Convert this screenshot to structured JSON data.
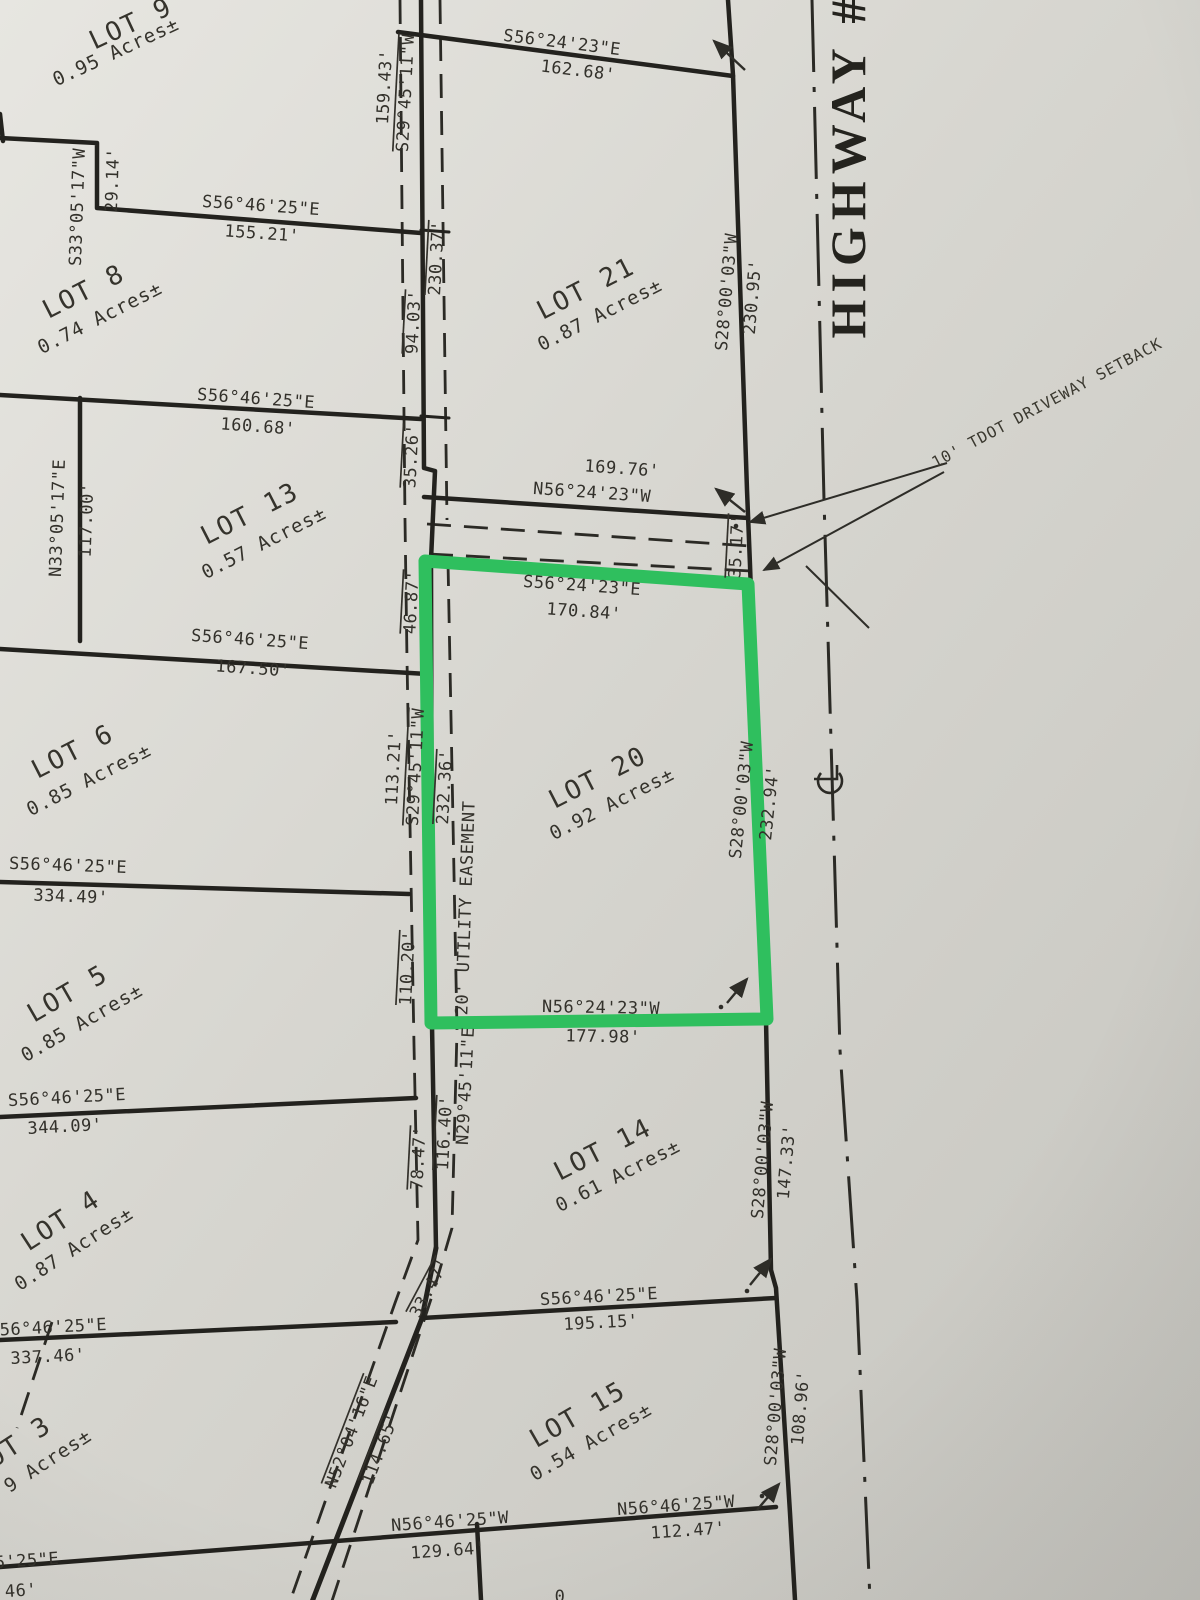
{
  "document": {
    "type": "subdivision-plat-scan",
    "highlighted_lot": "LOT 20"
  },
  "colors": {
    "highlight": "#2fbf5e",
    "ink": "#23221e",
    "paper_light": "#e6e5e0",
    "paper_mid": "#d7d6d0",
    "paper_dark": "#c7c6c0"
  },
  "labels": [
    {
      "n": "lot-9-name",
      "t": "LOT 9",
      "x": 131,
      "y": 24,
      "r": -25,
      "c": "lot-name"
    },
    {
      "n": "lot-9-area",
      "t": "0.95 Acres±",
      "x": 116,
      "y": 52,
      "r": -25,
      "c": "lot-area"
    },
    {
      "n": "lot-8-name",
      "t": "LOT 8",
      "x": 84,
      "y": 292,
      "r": -27,
      "c": "lot-name"
    },
    {
      "n": "lot-8-area",
      "t": "0.74 Acres±",
      "x": 100,
      "y": 318,
      "r": -27,
      "c": "lot-area"
    },
    {
      "n": "lot-13-name",
      "t": "LOT 13",
      "x": 250,
      "y": 514,
      "r": -27,
      "c": "lot-name"
    },
    {
      "n": "lot-13-area",
      "t": "0.57 Acres±",
      "x": 264,
      "y": 543,
      "r": -27,
      "c": "lot-area"
    },
    {
      "n": "lot-6-name",
      "t": "LOT 6",
      "x": 73,
      "y": 752,
      "r": -27,
      "c": "lot-name"
    },
    {
      "n": "lot-6-area",
      "t": "0.85 Acres±",
      "x": 89,
      "y": 780,
      "r": -27,
      "c": "lot-area"
    },
    {
      "n": "lot-5-name",
      "t": "LOT 5",
      "x": 68,
      "y": 994,
      "r": -30,
      "c": "lot-name"
    },
    {
      "n": "lot-5-area",
      "t": "0.85 Acres±",
      "x": 82,
      "y": 1023,
      "r": -30,
      "c": "lot-area"
    },
    {
      "n": "lot-4-name",
      "t": "LOT 4",
      "x": 61,
      "y": 1221,
      "r": -33,
      "c": "lot-name"
    },
    {
      "n": "lot-4-area",
      "t": "0.87 Acres±",
      "x": 74,
      "y": 1249,
      "r": -33,
      "c": "lot-area"
    },
    {
      "n": "lot-3-name",
      "t": "LOT 3",
      "x": 12,
      "y": 1447,
      "r": -33,
      "c": "lot-name"
    },
    {
      "n": "lot-3-area",
      "t": "9 Acres±",
      "x": 48,
      "y": 1461,
      "r": -33,
      "c": "lot-area"
    },
    {
      "n": "lot-21-name",
      "t": "LOT 21",
      "x": 586,
      "y": 289,
      "r": -27,
      "c": "lot-name"
    },
    {
      "n": "lot-21-area",
      "t": "0.87 Acres±",
      "x": 600,
      "y": 315,
      "r": -27,
      "c": "lot-area"
    },
    {
      "n": "lot-20-name",
      "t": "LOT 20",
      "x": 598,
      "y": 778,
      "r": -27,
      "c": "lot-name"
    },
    {
      "n": "lot-20-area",
      "t": "0.92 Acres±",
      "x": 612,
      "y": 804,
      "r": -27,
      "c": "lot-area"
    },
    {
      "n": "lot-14-name",
      "t": "LOT 14",
      "x": 603,
      "y": 1150,
      "r": -27,
      "c": "lot-name"
    },
    {
      "n": "lot-14-area",
      "t": "0.61 Acres±",
      "x": 618,
      "y": 1176,
      "r": -27,
      "c": "lot-area"
    },
    {
      "n": "lot-15-name",
      "t": "LOT 15",
      "x": 578,
      "y": 1415,
      "r": -30,
      "c": "lot-name"
    },
    {
      "n": "lot-15-area",
      "t": "0.54 Acres±",
      "x": 591,
      "y": 1442,
      "r": -30,
      "c": "lot-area"
    },
    {
      "n": "dim-bearing-155",
      "t": "S56°46'25\"E",
      "x": 261,
      "y": 206,
      "r": 4,
      "c": "dim"
    },
    {
      "n": "dim-155-21",
      "t": "155.21'",
      "x": 262,
      "y": 234,
      "r": 4,
      "c": "dim"
    },
    {
      "n": "dim-bearing-s330517w",
      "t": "S33°05'17\"W",
      "x": 78,
      "y": 207,
      "r": -88,
      "c": "dim"
    },
    {
      "n": "dim-29-14",
      "t": "29.14'",
      "x": 113,
      "y": 180,
      "r": -88,
      "c": "dim"
    },
    {
      "n": "dim-bearing-160",
      "t": "S56°46'25\"E",
      "x": 256,
      "y": 399,
      "r": 4,
      "c": "dim"
    },
    {
      "n": "dim-160-68",
      "t": "160.68'",
      "x": 258,
      "y": 427,
      "r": 4,
      "c": "dim"
    },
    {
      "n": "dim-bearing-n330517e",
      "t": "N33°05'17\"E",
      "x": 58,
      "y": 518,
      "r": -88,
      "c": "dim"
    },
    {
      "n": "dim-117-00",
      "t": "117.00'",
      "x": 87,
      "y": 520,
      "r": -88,
      "c": "dim"
    },
    {
      "n": "dim-bearing-167",
      "t": "S56°46'25\"E",
      "x": 250,
      "y": 640,
      "r": 4,
      "c": "dim"
    },
    {
      "n": "dim-167-50",
      "t": "167.50'",
      "x": 253,
      "y": 669,
      "r": 4,
      "c": "dim"
    },
    {
      "n": "dim-bearing-334",
      "t": "S56°46'25\"E",
      "x": 68,
      "y": 866,
      "r": 2,
      "c": "dim"
    },
    {
      "n": "dim-334-49",
      "t": "334.49'",
      "x": 71,
      "y": 897,
      "r": 2,
      "c": "dim"
    },
    {
      "n": "dim-bearing-344",
      "t": "S56°46'25\"E",
      "x": 67,
      "y": 1098,
      "r": -3,
      "c": "dim"
    },
    {
      "n": "dim-344-09",
      "t": "344.09'",
      "x": 65,
      "y": 1127,
      "r": -3,
      "c": "dim"
    },
    {
      "n": "dim-bearing-337",
      "t": "S56°46'25\"E",
      "x": 48,
      "y": 1328,
      "r": -3,
      "c": "dim"
    },
    {
      "n": "dim-337-46",
      "t": "337.46'",
      "x": 48,
      "y": 1357,
      "r": -3,
      "c": "dim"
    },
    {
      "n": "dim-partial-bearing",
      "t": "5'25\"E",
      "x": 27,
      "y": 1561,
      "r": -4,
      "c": "dim"
    },
    {
      "n": "dim-partial-46",
      "t": "46'",
      "x": 21,
      "y": 1591,
      "r": -4,
      "c": "dim"
    },
    {
      "n": "dim-bearing-162",
      "t": "S56°24'23\"E",
      "x": 562,
      "y": 43,
      "r": 7,
      "c": "dim"
    },
    {
      "n": "dim-162-68",
      "t": "162.68'",
      "x": 578,
      "y": 71,
      "r": 7,
      "c": "dim"
    },
    {
      "n": "dim-159-43",
      "t": "159.43'",
      "x": 385,
      "y": 87,
      "r": -87,
      "c": "dim"
    },
    {
      "n": "dim-bearing-s294511w-top",
      "t": "S29°45'11\"W",
      "x": 406,
      "y": 93,
      "r": -87,
      "c": "dim",
      "ol": true
    },
    {
      "n": "dim-230-37",
      "t": "230.37'",
      "x": 437,
      "y": 258,
      "r": -87,
      "c": "dim",
      "ol": true
    },
    {
      "n": "dim-94-03",
      "t": "94.03'",
      "x": 414,
      "y": 322,
      "r": -87,
      "c": "dim",
      "ol": true
    },
    {
      "n": "dim-35-26",
      "t": "35.26'",
      "x": 412,
      "y": 456,
      "r": -87,
      "c": "dim",
      "ol": true
    },
    {
      "n": "dim-46-87",
      "t": "46.87'",
      "x": 412,
      "y": 602,
      "r": -87,
      "c": "dim",
      "ol": true
    },
    {
      "n": "dim-bearing-s280003w-230",
      "t": "S28°00'03\"W",
      "x": 727,
      "y": 292,
      "r": -85,
      "c": "dim"
    },
    {
      "n": "dim-230-95",
      "t": "230.95'",
      "x": 753,
      "y": 297,
      "r": -85,
      "c": "dim"
    },
    {
      "n": "dim-169-76",
      "t": "169.76'",
      "x": 622,
      "y": 469,
      "r": 4,
      "c": "dim"
    },
    {
      "n": "dim-bearing-n562423w-169",
      "t": "N56°24'23\"W",
      "x": 592,
      "y": 493,
      "r": 4,
      "c": "dim"
    },
    {
      "n": "dim-35-17",
      "t": "35.17'",
      "x": 737,
      "y": 546,
      "r": -87,
      "c": "dim",
      "ol": true
    },
    {
      "n": "dim-bearing-170",
      "t": "S56°24'23\"E",
      "x": 582,
      "y": 586,
      "r": 4,
      "c": "dim"
    },
    {
      "n": "dim-170-84",
      "t": "170.84'",
      "x": 584,
      "y": 612,
      "r": 4,
      "c": "dim"
    },
    {
      "n": "dim-113-21",
      "t": "113.21'",
      "x": 394,
      "y": 768,
      "r": -87,
      "c": "dim"
    },
    {
      "n": "dim-bearing-s294511w-mid",
      "t": "S29°45'11\"W",
      "x": 416,
      "y": 767,
      "r": -87,
      "c": "dim",
      "ol": true
    },
    {
      "n": "dim-232-36",
      "t": "232.36'",
      "x": 445,
      "y": 787,
      "r": -87,
      "c": "dim",
      "ol": true
    },
    {
      "n": "easement-label",
      "t": "20' UTILITY EASEMENT",
      "x": 466,
      "y": 908,
      "r": -88,
      "c": "dim"
    },
    {
      "n": "dim-110-20",
      "t": "110.20'",
      "x": 408,
      "y": 968,
      "r": -87,
      "c": "dim",
      "ol": true
    },
    {
      "n": "dim-bearing-s280003w-232",
      "t": "S28°00'03\"W",
      "x": 742,
      "y": 800,
      "r": -84,
      "c": "dim"
    },
    {
      "n": "dim-232-94",
      "t": "232.94'",
      "x": 770,
      "y": 803,
      "r": -84,
      "c": "dim"
    },
    {
      "n": "dim-bearing-n562423w-177",
      "t": "N56°24'23\"W",
      "x": 601,
      "y": 1008,
      "r": 1,
      "c": "dim"
    },
    {
      "n": "dim-177-98",
      "t": "177.98'",
      "x": 603,
      "y": 1037,
      "r": 1,
      "c": "dim"
    },
    {
      "n": "dim-bearing-n294511e",
      "t": "N29°45'11\"E",
      "x": 466,
      "y": 1086,
      "r": -87,
      "c": "dim"
    },
    {
      "n": "dim-116-40",
      "t": "116.40'",
      "x": 445,
      "y": 1133,
      "r": -87,
      "c": "dim",
      "ol": true
    },
    {
      "n": "dim-78-47",
      "t": "78.47'",
      "x": 419,
      "y": 1158,
      "r": -87,
      "c": "dim",
      "ol": true
    },
    {
      "n": "dim-bearing-s280003w-147",
      "t": "S28°00'03\"W",
      "x": 763,
      "y": 1160,
      "r": -85,
      "c": "dim"
    },
    {
      "n": "dim-147-33",
      "t": "147.33'",
      "x": 787,
      "y": 1162,
      "r": -85,
      "c": "dim"
    },
    {
      "n": "dim-33-47",
      "t": "33.47'",
      "x": 430,
      "y": 1288,
      "r": -62,
      "c": "dim",
      "ol": true
    },
    {
      "n": "dim-bearing-195",
      "t": "S56°46'25\"E",
      "x": 599,
      "y": 1297,
      "r": -3,
      "c": "dim"
    },
    {
      "n": "dim-195-15",
      "t": "195.15'",
      "x": 601,
      "y": 1323,
      "r": -3,
      "c": "dim"
    },
    {
      "n": "dim-bearing-n520416e",
      "t": "N52°04'16\"E",
      "x": 352,
      "y": 1432,
      "r": -69,
      "c": "dim",
      "ol": true
    },
    {
      "n": "dim-114-65",
      "t": "114.65'",
      "x": 381,
      "y": 1449,
      "r": -69,
      "c": "dim",
      "ol": true
    },
    {
      "n": "dim-bearing-s280003w-108",
      "t": "S28°00'03\"W",
      "x": 776,
      "y": 1407,
      "r": -85,
      "c": "dim"
    },
    {
      "n": "dim-108-96",
      "t": "108.96'",
      "x": 801,
      "y": 1408,
      "r": -85,
      "c": "dim"
    },
    {
      "n": "dim-bearing-n564625w-129",
      "t": "N56°46'25\"W",
      "x": 450,
      "y": 1522,
      "r": -4,
      "c": "dim"
    },
    {
      "n": "dim-129-64",
      "t": "129.64'",
      "x": 448,
      "y": 1551,
      "r": -4,
      "c": "dim"
    },
    {
      "n": "dim-bearing-n564625w-112",
      "t": "N56°46'25\"W",
      "x": 676,
      "y": 1506,
      "r": -4,
      "c": "dim"
    },
    {
      "n": "dim-112-47",
      "t": "112.47'",
      "x": 688,
      "y": 1531,
      "r": -4,
      "c": "dim"
    },
    {
      "n": "setback-note",
      "t": "10' TDOT DRIVEWAY SETBACK",
      "x": 1047,
      "y": 403,
      "r": -28,
      "c": "note"
    },
    {
      "n": "highway-label",
      "t": "HIGHWAY #",
      "x": 848,
      "y": 165,
      "r": -90,
      "c": "hwy"
    },
    {
      "n": "partial-bottom-text",
      "t": "0",
      "x": 560,
      "y": 1597,
      "r": 0,
      "c": "dim"
    }
  ]
}
